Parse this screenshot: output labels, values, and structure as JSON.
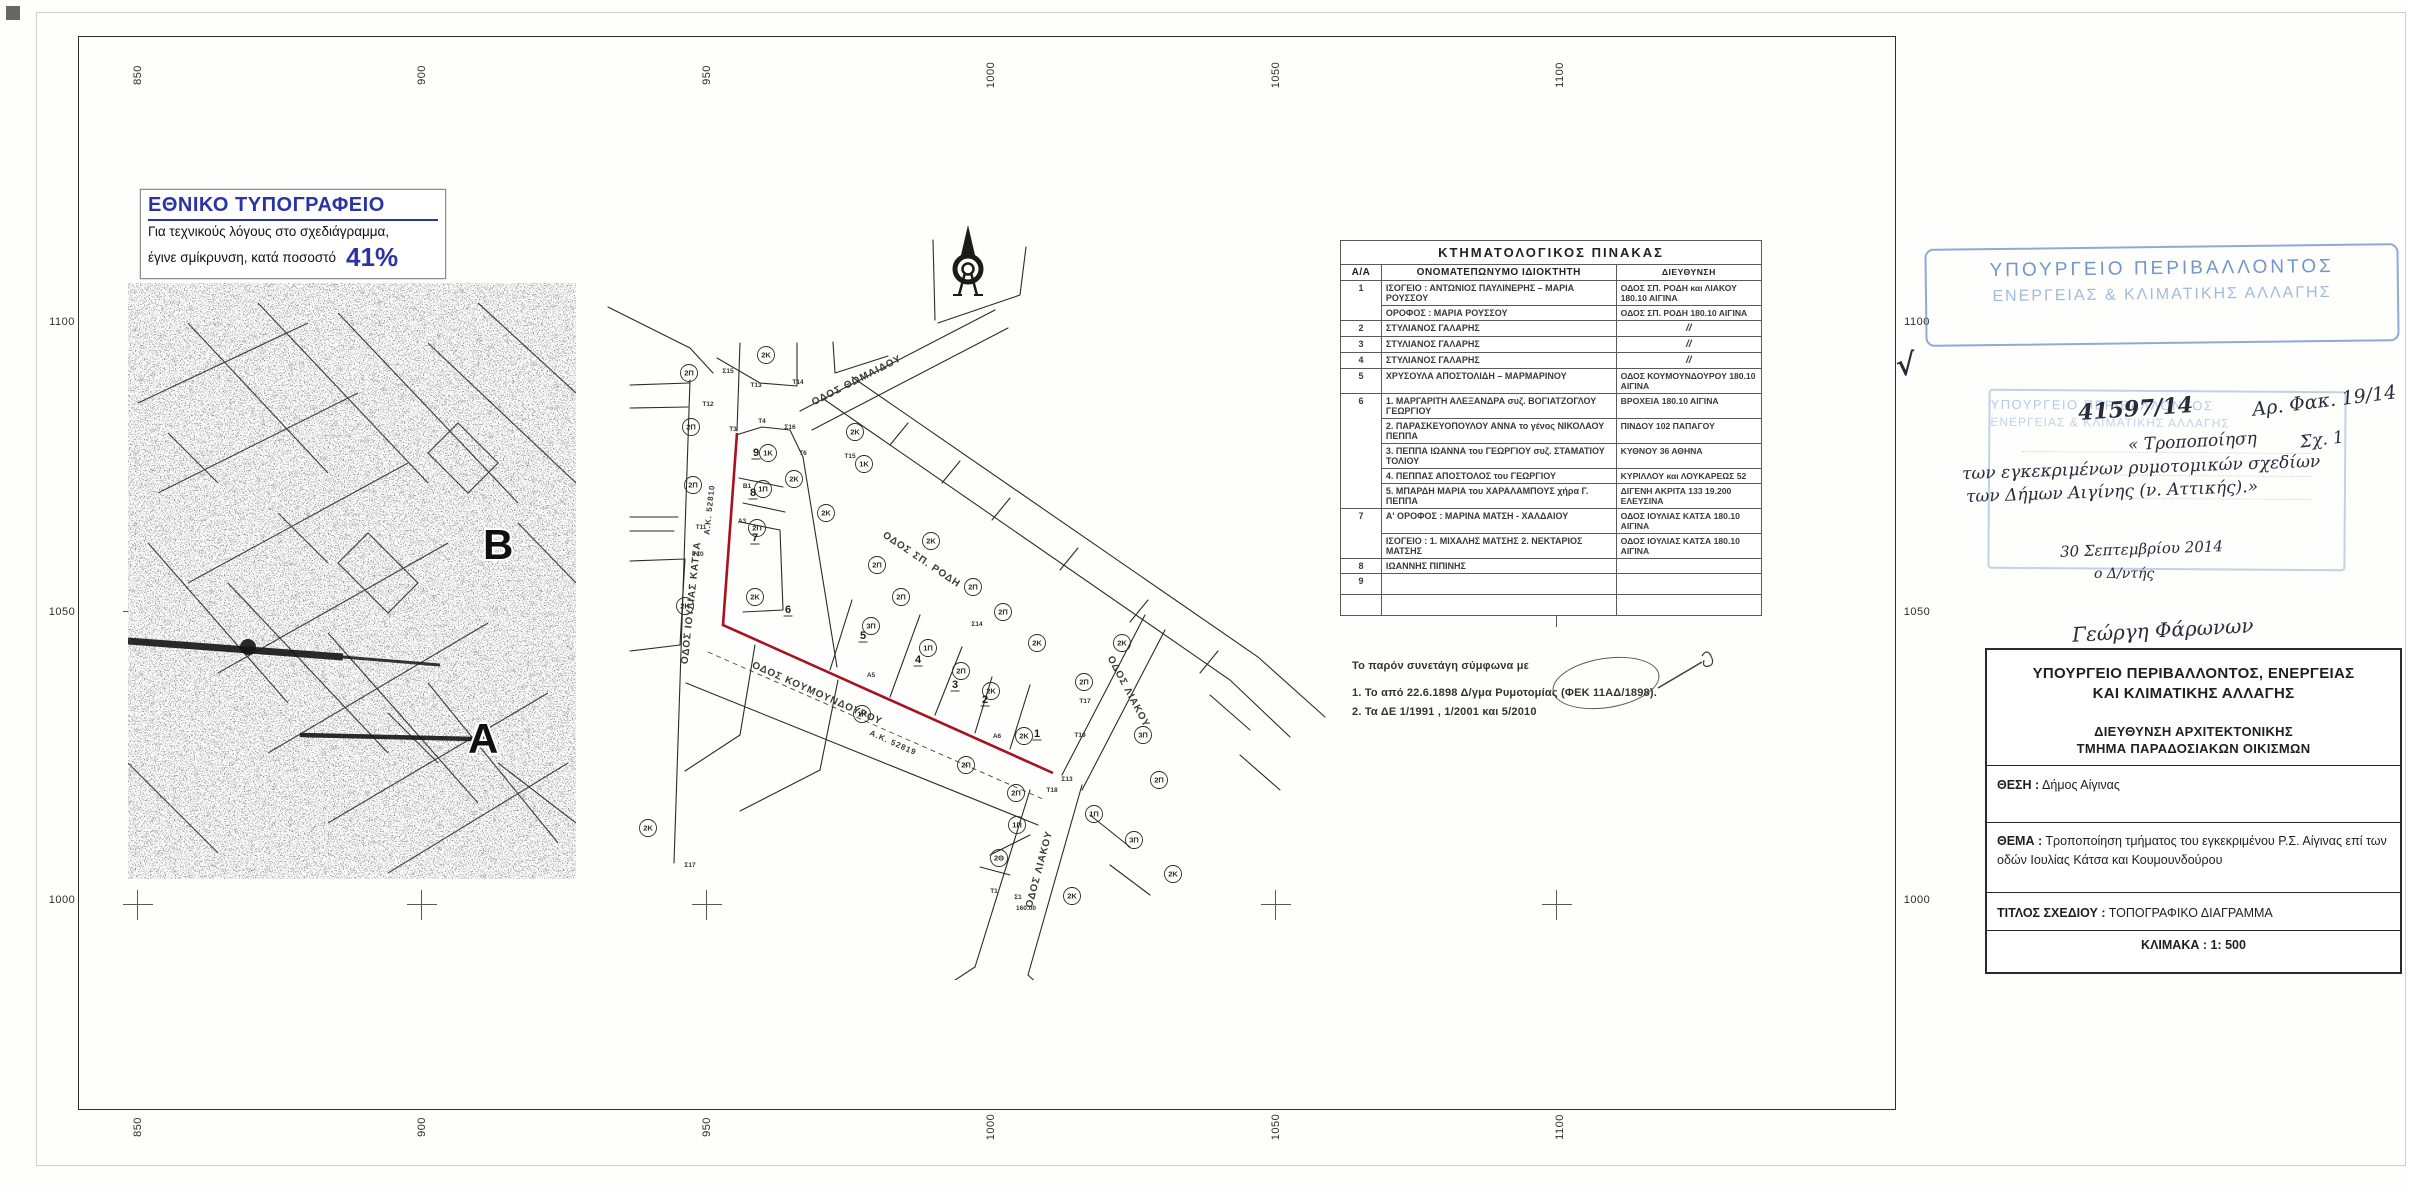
{
  "printer_note": {
    "title": "ΕΘΝΙΚΟ ΤΥΠΟΓΡΑΦΕΙΟ",
    "line1": "Για τεχνικούς λόγους στο σχεδιάγραμμα,",
    "line2": "έγινε σμίκρυνση, κατά ποσοστό",
    "percent": "41%"
  },
  "grid": {
    "top": [
      "850",
      "900",
      "950",
      "1000",
      "1050",
      "1100"
    ],
    "bottom": [
      "850",
      "900",
      "950",
      "1000",
      "1050",
      "1100"
    ],
    "left": [
      "1100",
      "1050",
      "1000"
    ],
    "right": [
      "1100",
      "1050",
      "1000"
    ]
  },
  "overview_map": {
    "label_b": "B",
    "label_a": "A"
  },
  "cadastral_table": {
    "title": "ΚΤΗΜΑΤΟΛΟΓΙΚΟΣ  ΠΙΝΑΚΑΣ",
    "headers": [
      "Α/Α",
      "ΟΝΟΜΑΤΕΠΩΝΥΜΟ ΙΔΙΟΚΤΗΤΗ",
      "ΔΙΕΥΘΥΝΣΗ"
    ],
    "rows": [
      {
        "num": "1",
        "entries": [
          {
            "name": "ΙΣΟΓΕΙΟ : ΑΝΤΩΝΙΟΣ ΠΑΥΛΙΝΕΡΗΣ – ΜΑΡΙΑ ΡΟΥΣΣΟΥ",
            "addr": "ΟΔΟΣ ΣΠ. ΡΟΔΗ και ΛΙΑΚΟΥ 180.10 ΑΙΓΙΝΑ"
          },
          {
            "name": "ΟΡΟΦΟΣ : ΜΑΡΙΑ ΡΟΥΣΣΟΥ",
            "addr": "ΟΔΟΣ ΣΠ. ΡΟΔΗ 180.10 ΑΙΓΙΝΑ"
          }
        ]
      },
      {
        "num": "2",
        "entries": [
          {
            "name": "ΣΤΥΛΙΑΝΟΣ ΓΑΛΑΡΗΣ",
            "addr": "//"
          }
        ]
      },
      {
        "num": "3",
        "entries": [
          {
            "name": "ΣΤΥΛΙΑΝΟΣ ΓΑΛΑΡΗΣ",
            "addr": "//"
          }
        ]
      },
      {
        "num": "4",
        "entries": [
          {
            "name": "ΣΤΥΛΙΑΝΟΣ ΓΑΛΑΡΗΣ",
            "addr": "//"
          }
        ]
      },
      {
        "num": "5",
        "entries": [
          {
            "name": "ΧΡΥΣΟΥΛΑ ΑΠΟΣΤΟΛΙΔΗ – ΜΑΡΜΑΡΙΝΟΥ",
            "addr": "ΟΔΟΣ ΚΟΥΜΟΥΝΔΟΥΡΟΥ 180.10 ΑΙΓΙΝΑ"
          }
        ]
      },
      {
        "num": "6",
        "entries": [
          {
            "name": "1.  ΜΑΡΓΑΡΙΤΗ ΑΛΕΞΑΝΔΡΑ συζ. ΒΟΓΙΑΤΖΟΓΛΟΥ ΓΕΩΡΓΙΟΥ",
            "addr": "ΒΡΟΧΕΙΑ  180.10 ΑΙΓΙΝΑ"
          },
          {
            "name": "2.  ΠΑΡΑΣΚΕΥΟΠΟΥΛΟΥ ΑΝΝΑ το γένος ΝΙΚΟΛΑΟΥ ΠΕΠΠΑ",
            "addr": "ΠΙΝΔΟΥ 102  ΠΑΠΑΓΟΥ"
          },
          {
            "name": "3.  ΠΕΠΠΑ ΙΩΑΝΝΑ του ΓΕΩΡΓΙΟΥ συζ. ΣΤΑΜΑΤΙΟΥ ΤΟΛΙΟΥ",
            "addr": "ΚΥΘΝΟΥ 36  ΑΘΗΝΑ"
          },
          {
            "name": "4.  ΠΕΠΠΑΣ ΑΠΟΣΤΟΛΟΣ του ΓΕΩΡΓΙΟΥ",
            "addr": "ΚΥΡΙΛΛΟΥ και ΛΟΥΚΑΡΕΩΣ 52"
          },
          {
            "name": "5.  ΜΠΑΡΔΗ ΜΑΡΙΑ του ΧΑΡΑΛΑΜΠΟΥΣ χήρα Γ. ΠΕΠΠΑ",
            "addr": "ΔΙΓΕΝΗ ΑΚΡΙΤΑ 133 19.200 ΕΛΕΥΣΙΝΑ"
          }
        ]
      },
      {
        "num": "7",
        "entries": [
          {
            "name": "Α' ΟΡΟΦΟΣ : ΜΑΡΙΝΑ  ΜΑΤΣΗ  -  ΧΑΛΔΑΙΟΥ",
            "addr": "ΟΔΟΣ ΙΟΥΛΙΑΣ ΚΑΤΣΑ 180.10 ΑΙΓΙΝΑ"
          },
          {
            "name": "ΙΣΟΓΕΙΟ :  1. ΜΙΧΑΛΗΣ  ΜΑΤΣΗΣ   2. ΝΕΚΤΑΡΙΟΣ ΜΑΤΣΗΣ",
            "addr": "ΟΔΟΣ ΙΟΥΛΙΑΣ ΚΑΤΣΑ 180.10 ΑΙΓΙΝΑ"
          }
        ]
      },
      {
        "num": "8",
        "entries": [
          {
            "name": "ΙΩΑΝΝΗΣ   ΠΙΠΙΝΗΣ",
            "addr": ""
          }
        ]
      },
      {
        "num": "9",
        "entries": [
          {
            "name": "",
            "addr": ""
          }
        ]
      },
      {
        "num": "",
        "entries": [
          {
            "name": "",
            "addr": ""
          }
        ]
      }
    ]
  },
  "notes": {
    "intro": "Το παρόν συνετάγη  σύμφωνα με",
    "item1": "1.  Το από  22.6.1898  Δ/γμα Ρυμοτομίας   (ΦΕΚ 11ΑΔ/1898).",
    "item2": "2. Τα  ΔΕ  1/1991 , 1/2001  και  5/2010"
  },
  "stamp": {
    "line1": "ΥΠΟΥΡΓΕΙΟ  ΠΕΡΙΒΑΛΛΟΝΤΟΣ",
    "line2": "ΕΝΕΡΓΕΙΑΣ  &  ΚΛΙΜΑΤΙΚΗΣ  ΑΛΛΑΓΗΣ"
  },
  "handwriting": {
    "checkmark": "√",
    "protocol": "41597/14",
    "subject_l1": "« Τροποποίηση",
    "subject_l2": "των εγκεκριμένων ρυμοτομικών σχεδίων",
    "subject_l3": "των Δήμων Αιγίνης (ν. Αττικής).»",
    "file_no": "Αρ. Φακ. 19/14",
    "sheet_no": "Σχ. 1",
    "date": "30 Σεπτεμβρίου 2014",
    "role": "ο Δ/ντής",
    "signature": "Γεώργη Φάρωνων"
  },
  "title_block": {
    "ministry_l1": "ΥΠΟΥΡΓΕΙΟ ΠΕΡΙΒΑΛΛΟΝΤΟΣ, ΕΝΕΡΓΕΙΑΣ",
    "ministry_l2": "ΚΑΙ ΚΛΙΜΑΤΙΚΗΣ ΑΛΛΑΓΗΣ",
    "dept_l1": "ΔΙΕΥΘΥΝΣΗ ΑΡΧΙΤΕΚΤΟΝΙΚΗΣ",
    "dept_l2": "ΤΜΗΜΑ ΠΑΡΑΔΟΣΙΑΚΩΝ ΟΙΚΙΣΜΩΝ",
    "location_label": "ΘΕΣΗ :",
    "location": "Δήμος Αίγινας",
    "subject_label": "ΘΕΜΑ :",
    "subject": "Τροποποίηση τμήματος του εγκεκριμένου Ρ.Σ. Αίγινας επί των οδών Ιουλίας Κάτσα και Κουμουνδούρου",
    "drawing_title_label": "ΤΙΤΛΟΣ ΣΧΕΔΙΟΥ :",
    "drawing_title": "ΤΟΠΟΓΡΑΦΙΚΟ   ΔΙΑΓΡΑΜΜΑ",
    "scale_label": "ΚΛΙΜΑΚΑ :",
    "scale": "1: 500"
  },
  "plan_map": {
    "street_labels": [
      {
        "t": "ΟΔΟΣ ΙΟΥΛΙΑΣ ΚΑΤΣΑ",
        "x": 104,
        "y": 388,
        "r": -84,
        "s": 10
      },
      {
        "t": "Α.Κ. 52810",
        "x": 122,
        "y": 295,
        "r": -84,
        "s": 8
      },
      {
        "t": "ΟΔΟΣ  ΘΩΜΑΙΔΟΥ",
        "x": 268,
        "y": 168,
        "r": -27,
        "s": 10
      },
      {
        "t": "ΟΔΟΣ  ΣΠ. ΡΟΔΗ",
        "x": 330,
        "y": 347,
        "r": 34,
        "s": 10
      },
      {
        "t": "ΟΔΟΣ  ΚΟΥΜΟΥΝΔΟΥΡΟΥ",
        "x": 226,
        "y": 481,
        "r": 24,
        "s": 10
      },
      {
        "t": "Α.Κ. 52819",
        "x": 302,
        "y": 530,
        "r": 24,
        "s": 8
      },
      {
        "t": "ΟΔΟΣ ΛΙΑΚΟΥ",
        "x": 452,
        "y": 655,
        "r": -75,
        "s": 10
      },
      {
        "t": "ΟΔΟΣ ΛΙΑΚΟΥ",
        "x": 536,
        "y": 478,
        "r": 62,
        "s": 10
      }
    ],
    "zone_labels": [
      [
        99,
        158,
        "2Π"
      ],
      [
        176,
        140,
        "2Κ"
      ],
      [
        101,
        212,
        "2Π"
      ],
      [
        103,
        270,
        "2Π"
      ],
      [
        95,
        391,
        "2Κ"
      ],
      [
        58,
        613,
        "2Κ"
      ],
      [
        178,
        238,
        "1Κ"
      ],
      [
        173,
        274,
        "1Π"
      ],
      [
        204,
        264,
        "2Κ"
      ],
      [
        236,
        298,
        "2Κ"
      ],
      [
        265,
        217,
        "2Κ"
      ],
      [
        274,
        249,
        "1Κ"
      ],
      [
        167,
        313,
        "2Π"
      ],
      [
        341,
        326,
        "2Κ"
      ],
      [
        287,
        350,
        "2Π"
      ],
      [
        311,
        382,
        "2Π"
      ],
      [
        383,
        372,
        "2Π"
      ],
      [
        413,
        397,
        "2Π"
      ],
      [
        165,
        382,
        "2Κ"
      ],
      [
        281,
        411,
        "3Π"
      ],
      [
        338,
        433,
        "1Π"
      ],
      [
        371,
        456,
        "2Π"
      ],
      [
        401,
        476,
        "2Κ"
      ],
      [
        447,
        428,
        "2Κ"
      ],
      [
        532,
        428,
        "2Κ"
      ],
      [
        494,
        467,
        "2Π"
      ],
      [
        272,
        499,
        "1Κ"
      ],
      [
        434,
        521,
        "2Κ"
      ],
      [
        553,
        520,
        "3Π"
      ],
      [
        376,
        550,
        "2Π"
      ],
      [
        426,
        578,
        "2Π"
      ],
      [
        569,
        565,
        "2Π"
      ],
      [
        504,
        599,
        "1Π"
      ],
      [
        427,
        610,
        "1Π"
      ],
      [
        544,
        625,
        "3Π"
      ],
      [
        409,
        643,
        "2Θ"
      ],
      [
        482,
        681,
        "2Κ"
      ],
      [
        583,
        659,
        "2Κ"
      ]
    ],
    "parcel_numbers": [
      [
        166,
        241,
        "9"
      ],
      [
        163,
        281,
        "8"
      ],
      [
        165,
        326,
        "7"
      ],
      [
        198,
        398,
        "6"
      ],
      [
        273,
        424,
        "5"
      ],
      [
        328,
        448,
        "4"
      ],
      [
        365,
        473,
        "3"
      ],
      [
        395,
        488,
        "2"
      ],
      [
        447,
        522,
        "1"
      ]
    ],
    "point_labels": [
      [
        138,
        158,
        "Σ15"
      ],
      [
        200,
        214,
        "Σ16"
      ],
      [
        387,
        411,
        "Σ14"
      ],
      [
        477,
        566,
        "Σ13"
      ],
      [
        143,
        216,
        "Τ3"
      ],
      [
        172,
        208,
        "Τ4"
      ],
      [
        213,
        240,
        "Τ6"
      ],
      [
        118,
        191,
        "Τ12"
      ],
      [
        166,
        172,
        "Τ13"
      ],
      [
        208,
        169,
        "Τ14"
      ],
      [
        260,
        243,
        "Τ15"
      ],
      [
        111,
        314,
        "Τ11"
      ],
      [
        108,
        341,
        "Τ10"
      ],
      [
        495,
        488,
        "Τ17"
      ],
      [
        490,
        522,
        "Τ19"
      ],
      [
        462,
        577,
        "Τ18"
      ],
      [
        157,
        273,
        "Β1"
      ],
      [
        152,
        308,
        "Α3"
      ],
      [
        281,
        462,
        "Α5"
      ],
      [
        407,
        523,
        "Α6"
      ],
      [
        404,
        678,
        "Τ1"
      ],
      [
        428,
        684,
        "Σ1"
      ],
      [
        436,
        695,
        "160.00"
      ],
      [
        100,
        652,
        "Σ17"
      ]
    ]
  },
  "colors": {
    "accent_blue": "#2a34a4",
    "stamp_blue": "#6f9bd1",
    "red_line": "#a61220"
  }
}
